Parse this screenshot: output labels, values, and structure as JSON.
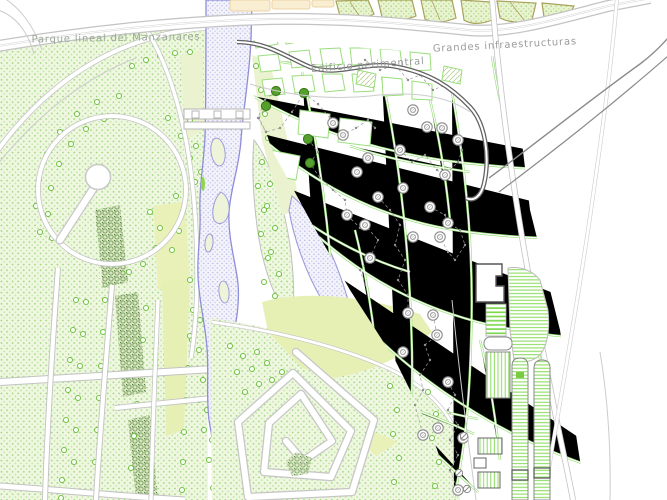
{
  "map": {
    "labels": {
      "park": "Parque lineal del Manzanares",
      "perimeter_building": "Edificio perimentral",
      "infrastructure": "Grandes infraestructuras"
    },
    "colors": {
      "text_park": "#9aa795",
      "text_gray": "#9b9b9b",
      "park_dot": "#97d176",
      "park_bg": "#eff7e0",
      "river_outline": "#8d8dda",
      "river_fill": "#f3f3fb",
      "path_green": "#9ade7c",
      "road_gray": "#c3c3c3",
      "building_band": "#636363",
      "node_green": "#55a02c",
      "node_gray": "#8a8a8a",
      "tree_green": "#6cc13e",
      "block_orange": "#f9edd2"
    }
  }
}
